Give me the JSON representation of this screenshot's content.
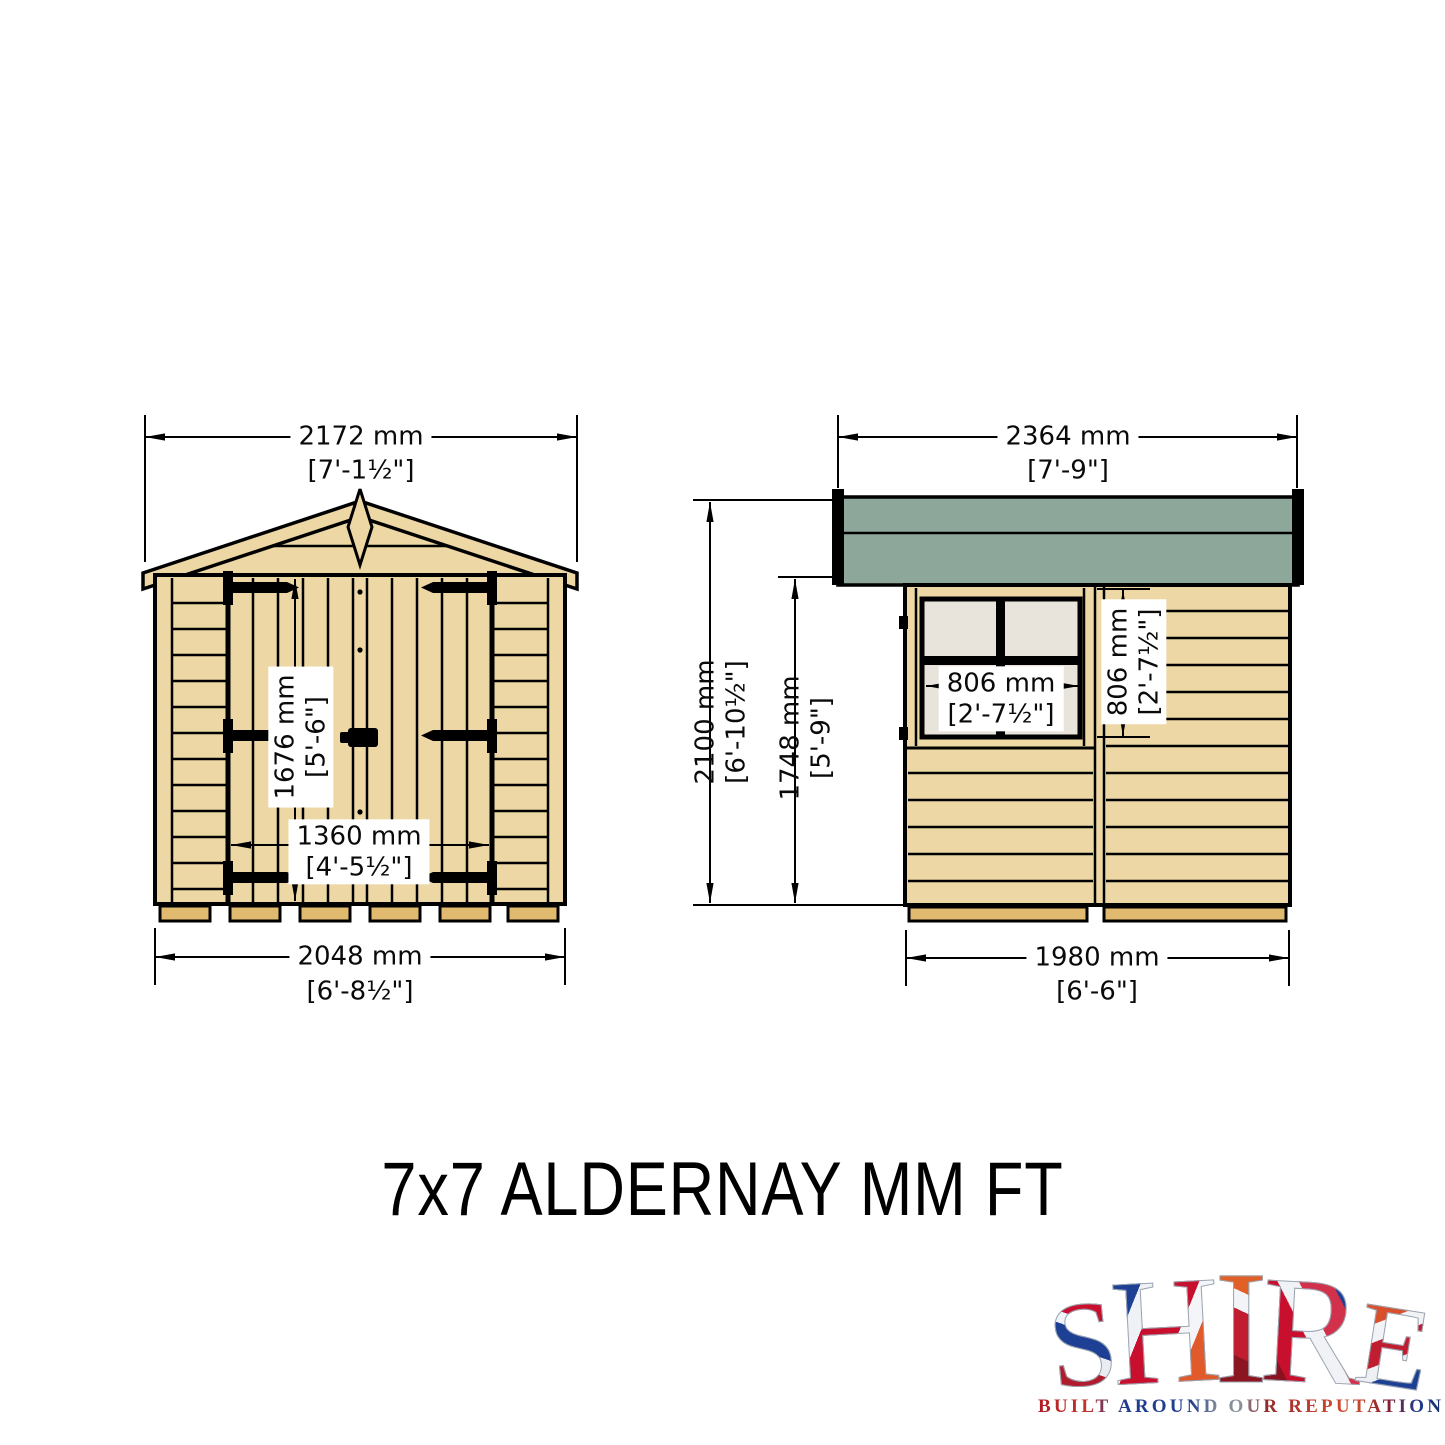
{
  "title": "7x7 ALDERNAY MM FT",
  "front_view": {
    "roof_width_mm": "2172 mm",
    "roof_width_ft": "[7'-1½\"]",
    "door_height_mm": "1676 mm",
    "door_height_ft": "[5'-6\"]",
    "door_width_mm": "1360 mm",
    "door_width_ft": "[4'-5½\"]",
    "base_width_mm": "2048 mm",
    "base_width_ft": "[6'-8½\"]"
  },
  "side_view": {
    "roof_length_mm": "2364 mm",
    "roof_length_ft": "[7'-9\"]",
    "ridge_height_mm": "2100 mm",
    "ridge_height_ft": "[6'-10½\"]",
    "eaves_height_mm": "1748 mm",
    "eaves_height_ft": "[5'-9\"]",
    "window_width_mm": "806 mm",
    "window_width_ft": "[2'-7½\"]",
    "window_height_mm": "806 mm",
    "window_height_ft": "[2'-7½\"]",
    "base_length_mm": "1980 mm",
    "base_length_ft": "[6'-6\"]"
  },
  "logo": {
    "letters": [
      "S",
      "H",
      "I",
      "R",
      "E"
    ],
    "tagline": "BUILT AROUND OUR REPUTATION"
  },
  "colors": {
    "wood": "#edd8a5",
    "wood_dark": "#e0ba6e",
    "roof_felt_green": "#8da79a",
    "window_pane": "#e8e4db",
    "outline": "#000000"
  }
}
